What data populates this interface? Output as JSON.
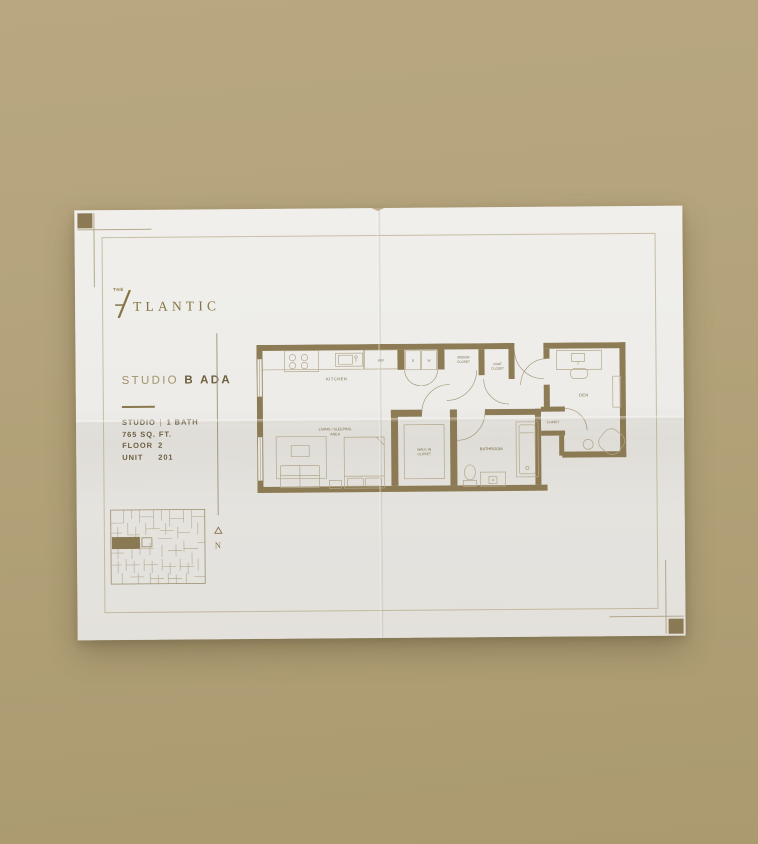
{
  "background_color": "#b3a279",
  "paper_color": "#edece8",
  "accent_color": "#8b7a53",
  "brand": {
    "the": "THE",
    "name": "TLANTIC"
  },
  "plan_title": {
    "prefix": "STUDIO",
    "bold": "B ADA"
  },
  "details": {
    "type_label": "STUDIO",
    "separator": "|",
    "bath_label": "1 BATH",
    "area": "765 SQ. FT.",
    "floor_label": "FLOOR",
    "floor_value": "2",
    "unit_label": "UNIT",
    "unit_value": "201"
  },
  "north_letter": "N",
  "floorplan": {
    "labels": {
      "kitchen": "KITCHEN",
      "ref": "REF",
      "dryer": "D",
      "washer": "W",
      "broom_line1": "BROOM",
      "broom_line2": "CLOSET",
      "coat_line1": "COAT",
      "coat_line2": "CLOSET",
      "living_line1": "LIVING / SLEEPING",
      "living_line2": "AREA",
      "walkin_line1": "WALK-IN",
      "walkin_line2": "CLOSET",
      "bathroom": "BATHROOM",
      "den": "DEN",
      "closet": "CLOSET"
    }
  }
}
